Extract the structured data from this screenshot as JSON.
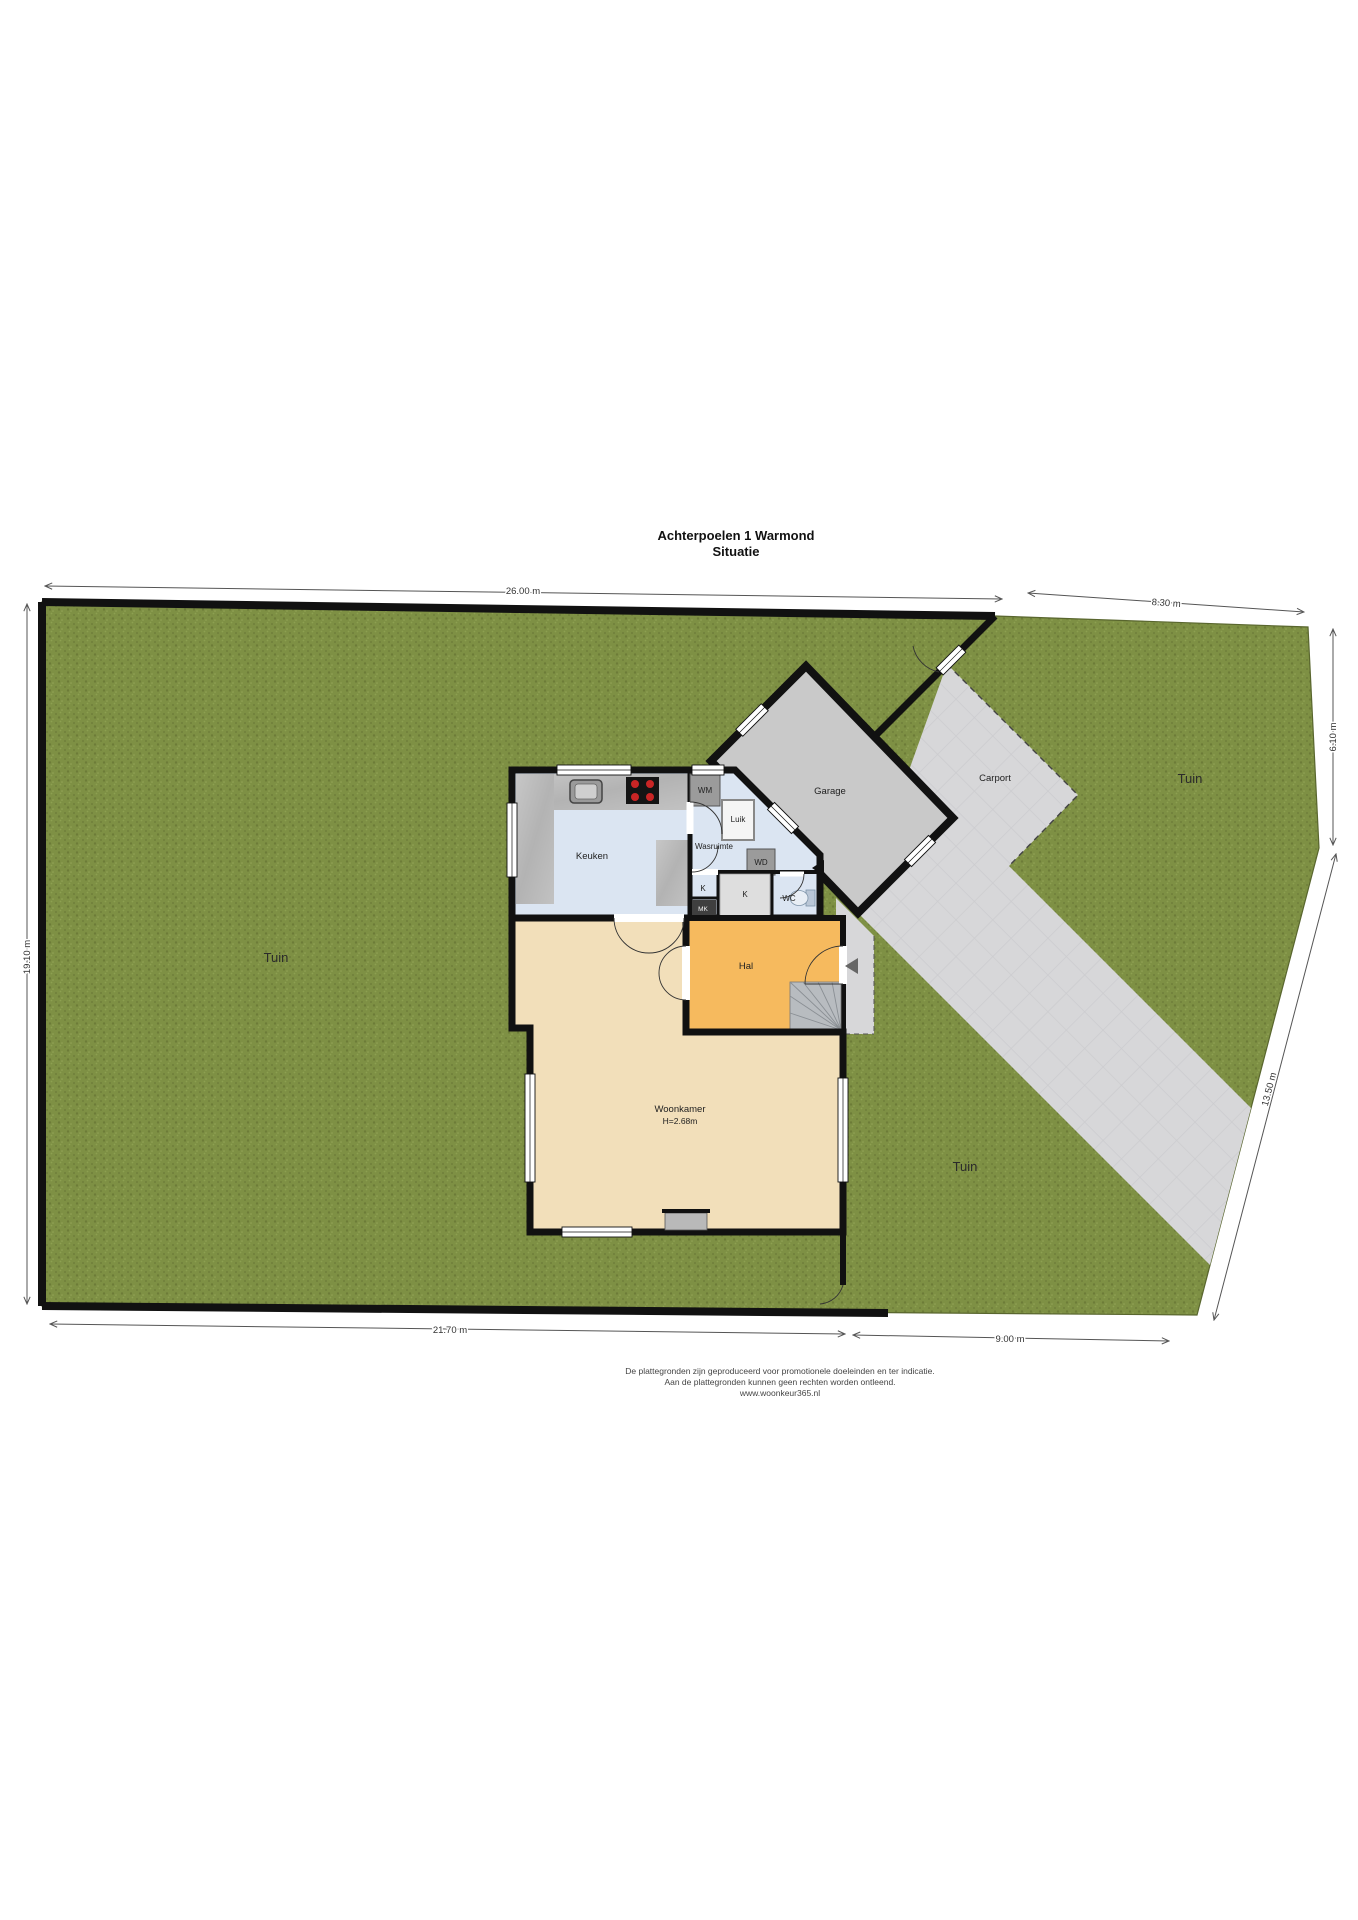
{
  "title": {
    "line1": "Achterpoelen 1  Warmond",
    "line2": "Situatie"
  },
  "plot_dimensions": {
    "top": "26.00 m",
    "top_right": "8.30 m",
    "left": "19.10 m",
    "right": "6.10 m",
    "right_diagonal": "13.50 m",
    "bottom": "21.70 m",
    "bottom_right": "9.00 m"
  },
  "garden": {
    "tuin_left": "Tuin",
    "tuin_top_right": "Tuin",
    "tuin_bottom_right": "Tuin"
  },
  "rooms": {
    "keuken": "Keuken",
    "wasruimte": "Wasruimte",
    "wm": "WM",
    "luik": "Luik",
    "wd": "WD",
    "k_closet_small": "K",
    "k_closet_large": "K",
    "mk": "MK",
    "wc": "WC",
    "hal": "Hal",
    "garage": "Garage",
    "carport": "Carport",
    "woonkamer": "Woonkamer",
    "woonkamer_height": "H=2.68m"
  },
  "footer": {
    "line1": "De plattegronden zijn geproduceerd voor promotionele doeleinden en ter indicatie.",
    "line2": "Aan de plattegronden kunnen geen rechten worden ontleend.",
    "line3": "www.woonkeur365.nl"
  },
  "colors": {
    "grass": "#7e9044",
    "paving": "#d7d7d9",
    "garage_floor": "#c9c9c9",
    "floor_blue": "#dbe5f2",
    "hal_orange": "#f6ba5e",
    "woonkamer_beige": "#f2dfba",
    "wall": "#111111",
    "dimension_line": "#555555"
  }
}
